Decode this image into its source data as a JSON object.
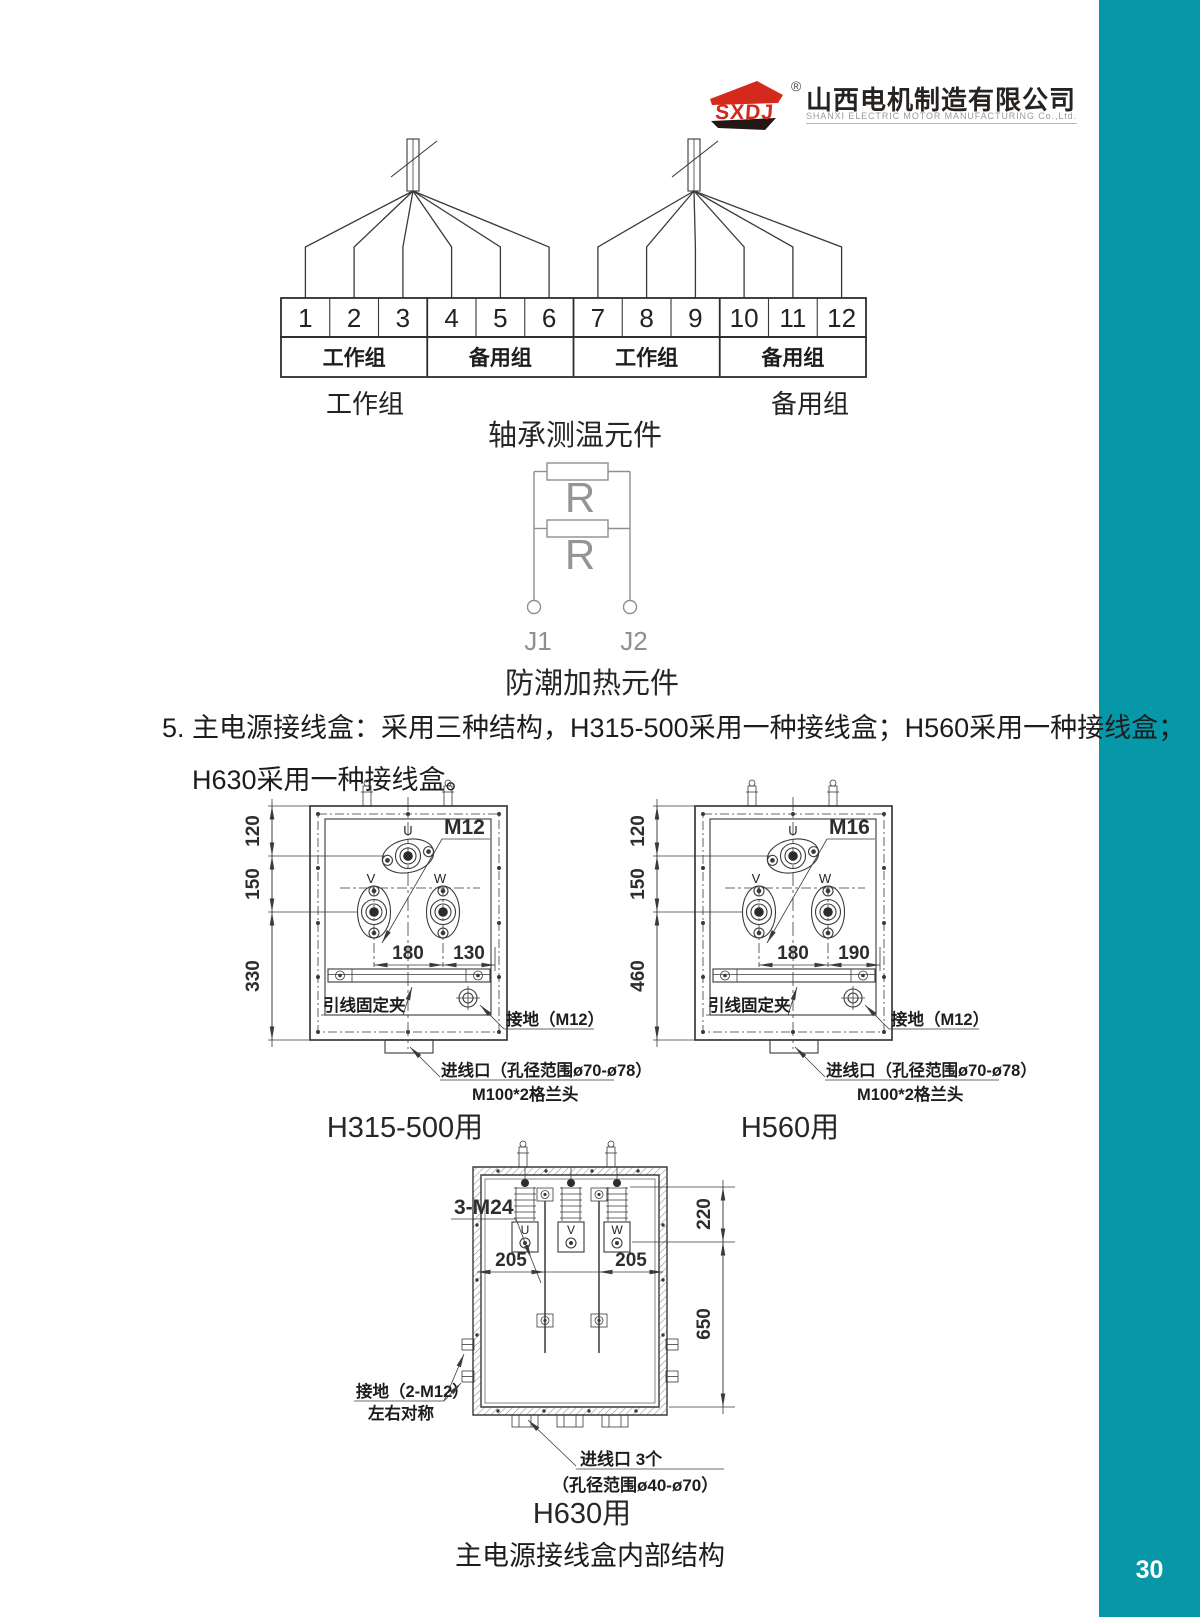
{
  "page": {
    "number": "30"
  },
  "logo": {
    "mark": "SXDJ",
    "registered": "®",
    "cn": "山西电机制造有限公司",
    "en": "SHANXI ELECTRIC MOTOR MANUFACTURING Co.,Ltd."
  },
  "bearing": {
    "cells": [
      "1",
      "2",
      "3",
      "4",
      "5",
      "6",
      "7",
      "8",
      "9",
      "10",
      "11",
      "12"
    ],
    "groups": [
      "工作组",
      "备用组",
      "工作组",
      "备用组"
    ],
    "left_label": "工作组",
    "right_label": "备用组",
    "caption": "轴承测温元件"
  },
  "heater": {
    "r1": "R",
    "r2": "R",
    "j1": "J1",
    "j2": "J2",
    "caption": "防潮加热元件"
  },
  "section5": {
    "line1": "5. 主电源接线盒：采用三种结构，H315-500采用一种接线盒；H560采用一种接线盒；",
    "line2": "H630采用一种接线盒。"
  },
  "box1": {
    "dim_top": "120",
    "dim_mid": "150",
    "dim_bot": "330",
    "dim_vw": "180",
    "dim_edge": "130",
    "bolt": "M12",
    "u": "U",
    "v": "V",
    "w": "W",
    "clamp": "引线固定夹",
    "ground": "接地（M12）",
    "inlet1": "进线口（孔径范围ø70-ø78）",
    "inlet2": "M100*2格兰头",
    "caption": "H315-500用"
  },
  "box2": {
    "dim_top": "120",
    "dim_mid": "150",
    "dim_bot": "460",
    "dim_vw": "180",
    "dim_edge": "190",
    "bolt": "M16",
    "u": "U",
    "v": "V",
    "w": "W",
    "clamp": "引线固定夹",
    "ground": "接地（M12）",
    "inlet1": "进线口（孔径范围ø70-ø78）",
    "inlet2": "M100*2格兰头",
    "caption": "H560用"
  },
  "box3": {
    "bolt": "3-M24",
    "u": "U",
    "v": "V",
    "w": "W",
    "dim_l": "205",
    "dim_r": "205",
    "dim_top": "220",
    "dim_bot": "650",
    "ground1": "接地（2-M12）",
    "ground2": "左右对称",
    "inlet1": "进线口 3个",
    "inlet2": "（孔径范围ø40-ø70）",
    "caption": "H630用"
  },
  "footer": {
    "caption": "主电源接线盒内部结构"
  }
}
